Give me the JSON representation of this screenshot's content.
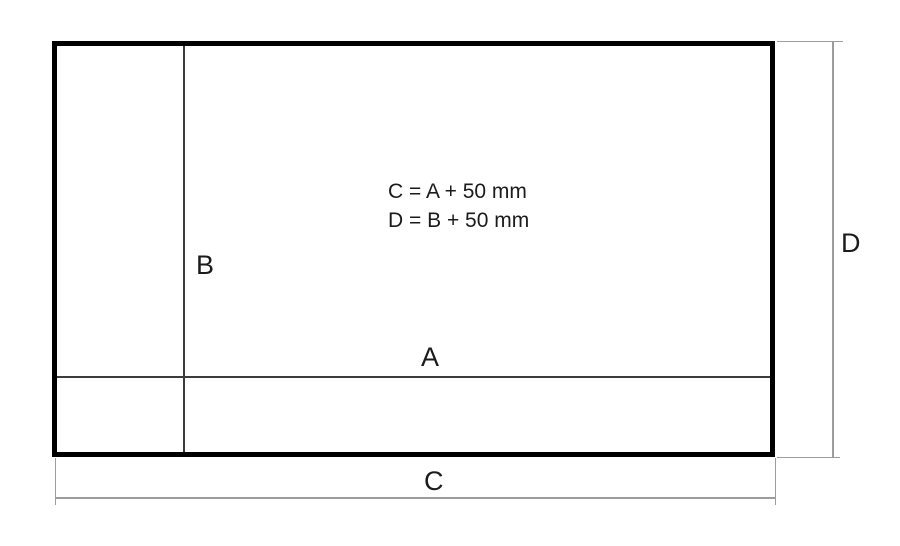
{
  "diagram": {
    "labels": {
      "a": "A",
      "b": "B",
      "c": "C",
      "d": "D"
    },
    "formulas": {
      "c_formula": "C = A + 50 mm",
      "d_formula": "D = B + 50 mm"
    },
    "colors": {
      "outer_border": "#000000",
      "inner_line": "#3c3c3c",
      "dimension_line": "#9c9c9c",
      "text": "#1b1b1b",
      "background": "#ffffff"
    }
  }
}
